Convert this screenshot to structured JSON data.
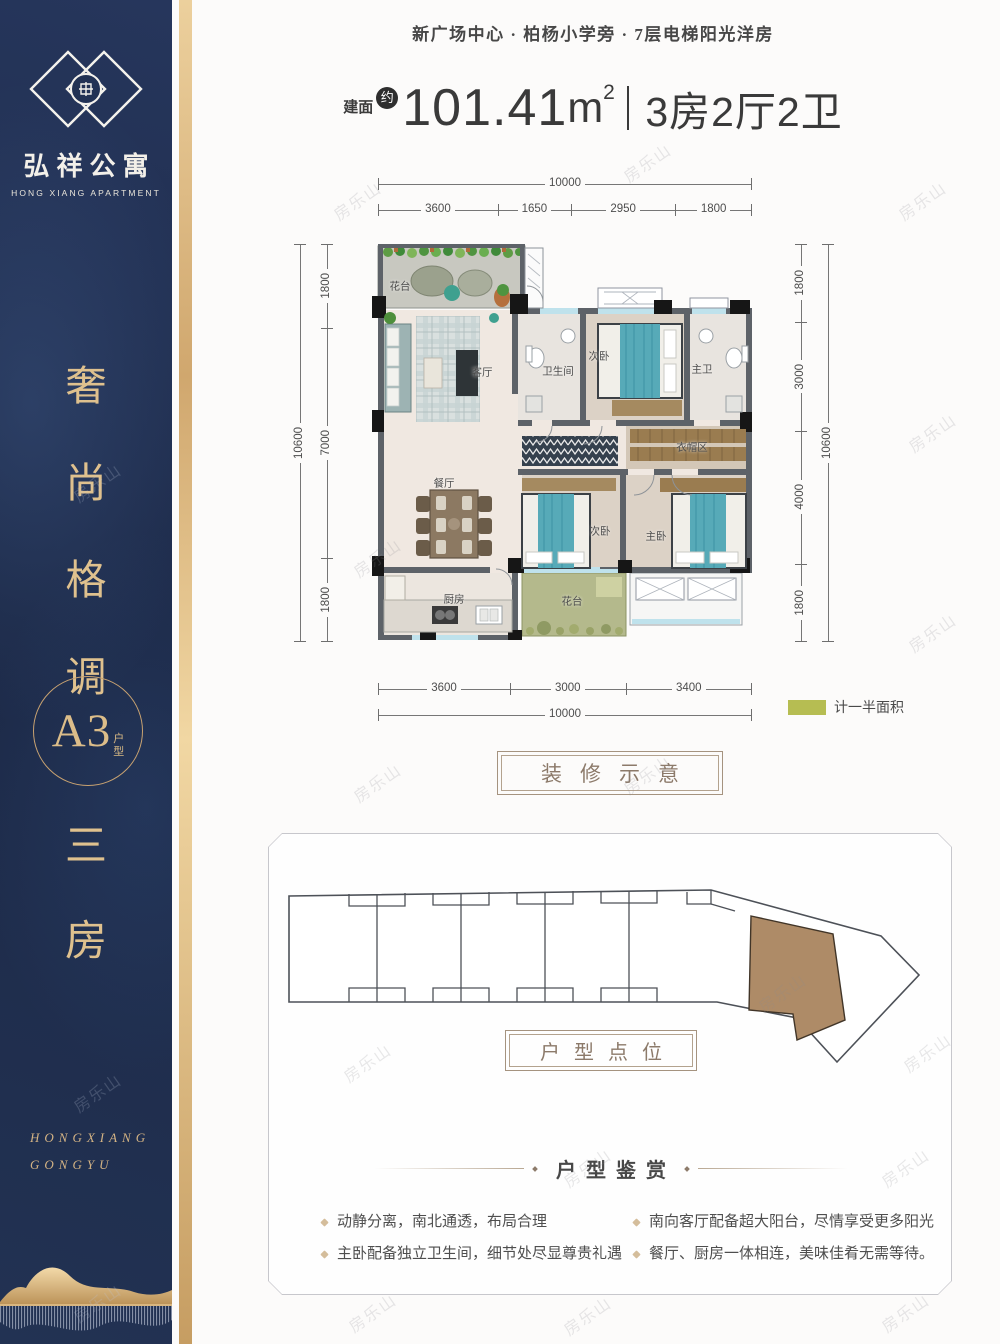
{
  "watermark": {
    "text": "房乐山"
  },
  "sidebar": {
    "logo": {
      "cn": "弘祥公寓",
      "en": "HONG XIANG APARTMENT"
    },
    "slogan": [
      "奢",
      "尚",
      "格",
      "调"
    ],
    "badge": {
      "code": "A3",
      "suffix": [
        "户",
        "型"
      ]
    },
    "type_chars": [
      "三",
      "房"
    ],
    "footer": [
      "HONGXIANG",
      "GONGYU"
    ]
  },
  "header": {
    "tagline": "新广场中心 · 柏杨小学旁 · 7层电梯阳光洋房"
  },
  "title": {
    "area_label": "建面",
    "approx": "约",
    "value": "101.41",
    "unit": "m",
    "power": "2",
    "rooms": "3房2厅2卫"
  },
  "floorplan": {
    "rooms": {
      "terrace_top": "花台",
      "living": "客厅",
      "bath": "卫生间",
      "bedroom2_top": "次卧",
      "master_bath": "主卫",
      "cloak": "衣帽区",
      "dining": "餐厅",
      "bedroom2_bottom": "次卧",
      "master_bedroom": "主卧",
      "kitchen": "厨房",
      "terrace_bottom": "花台"
    },
    "dims": {
      "top_total": "10000",
      "top_segments": [
        "3600",
        "1650",
        "2950",
        "1800"
      ],
      "left_total": "10600",
      "left_segments": [
        "1800",
        "7000",
        "1800"
      ],
      "right_segments": [
        "1800",
        "3000",
        "4000",
        "1800"
      ],
      "right_total": "10600",
      "bottom_segments": [
        "3600",
        "3000",
        "3400"
      ],
      "bottom_total": "10000"
    },
    "legend": {
      "label": "计一半面积",
      "color": "#b6bd52"
    }
  },
  "labels": {
    "decor": "装修示意",
    "location": "户型点位"
  },
  "review": {
    "heading": "户型鉴赏",
    "left": [
      "动静分离，南北通透，布局合理",
      "主卧配备独立卫生间，细节处尽显尊贵礼遇"
    ],
    "right": [
      "南向客厅配备超大阳台，尽情享受更多阳光",
      "餐厅、厨房一体相连，美味佳肴无需等待。"
    ]
  }
}
